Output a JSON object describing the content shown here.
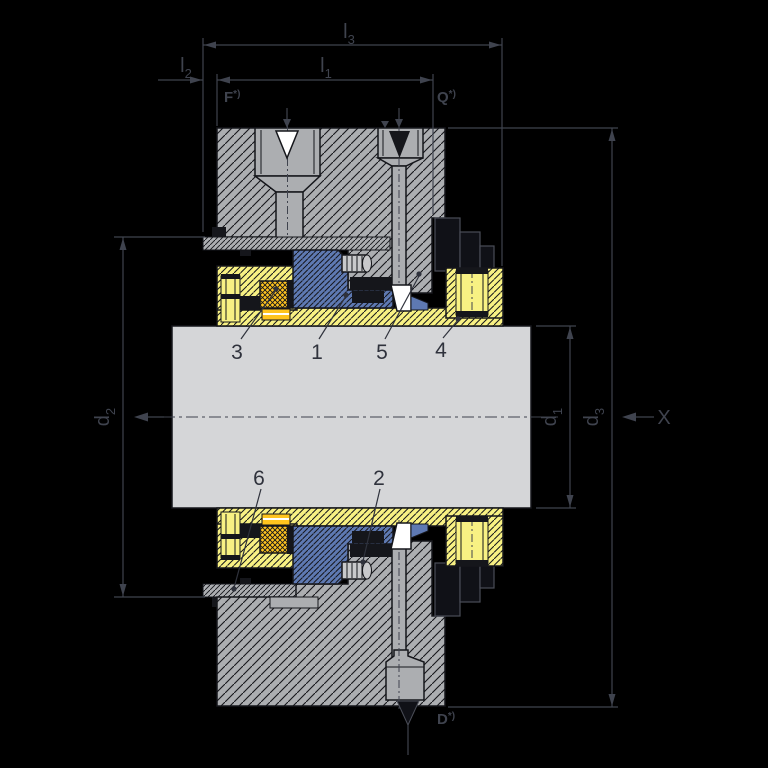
{
  "drawing": {
    "kind": "mechanical-seal-cross-section-drawing",
    "dim_labels": {
      "l1": {
        "base": "l",
        "sub": "1"
      },
      "l2": {
        "base": "l",
        "sub": "2"
      },
      "l3": {
        "base": "l",
        "sub": "3"
      },
      "d1": {
        "base": "d",
        "sub": "1"
      },
      "d2": {
        "base": "d",
        "sub": "2"
      },
      "d3": {
        "base": "d",
        "sub": "3"
      },
      "x_axis": "X"
    },
    "port_labels": {
      "flush": {
        "base": "F",
        "note": "*)"
      },
      "quench": {
        "base": "Q",
        "note": "*)"
      },
      "drain": {
        "base": "D",
        "note": "*)"
      }
    },
    "part_numbers": [
      "1",
      "2",
      "3",
      "4",
      "5",
      "6"
    ],
    "colors": {
      "background": "#000000",
      "ink": "#15161B",
      "dim": "#3F434E",
      "label": "#2F323C",
      "housing": "#ACAEB1",
      "shaft": "#D5D6D8",
      "sleeve": "#F8F183",
      "gold": "#FFC41E",
      "blue": "#5E79B2",
      "white": "#FFFFFF",
      "dark_part": "#101117",
      "dark_part_edge": "#4A4D57",
      "spring": "#C8C9CB"
    }
  }
}
